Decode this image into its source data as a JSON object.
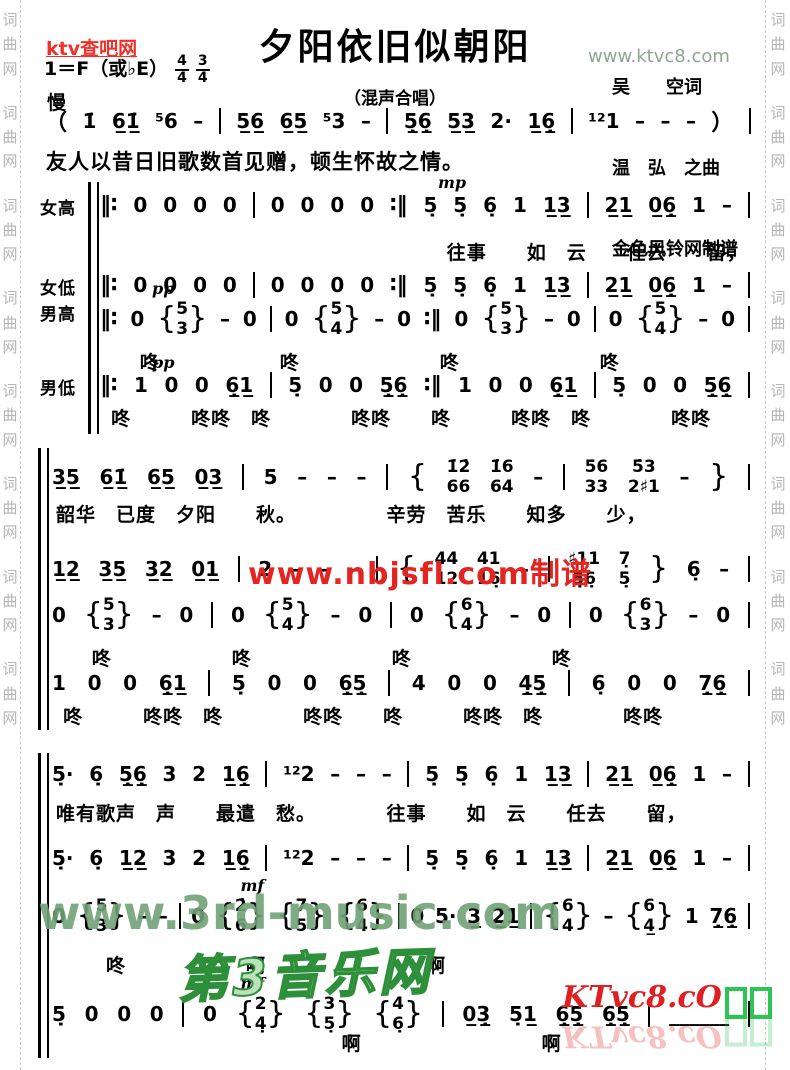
{
  "watermarks": {
    "side_strip_text": "词曲网",
    "ktv_red": "ktv查吧网",
    "ktvc8_top": "www.ktvc8.com",
    "nbjsfl_red": "www.nbjsfl.com制谱",
    "music3rd_green": "www.3rd-music.com",
    "music3rd_cn": "第3音乐网",
    "ktvc8_bottom": "KTvc8.cO",
    "colors": {
      "red": "#e42420",
      "gray_green": "#8fa58f",
      "green": "#70a276",
      "dark_green": "#2e8f3a",
      "strip_gray": "#b5b5b5"
    }
  },
  "header": {
    "title": "夕阳依旧似朝阳",
    "subtitle": "（混声合唱）",
    "key_signature": "1＝F（或♭E）",
    "time_signatures": [
      {
        "num": "4",
        "den": "4"
      },
      {
        "num": "3",
        "den": "4"
      }
    ],
    "tempo": "慢",
    "credits": [
      "吴　　空词",
      "温　弘　之曲",
      "金色风铃网制谱"
    ]
  },
  "intro": {
    "notes": "（ 1̇ 6̲1̲̇ ⁵6 – | 5̲6̲ 6̲5̲ ⁵3 – | 5̲̣6̲̣ 5̲3̲ 2· 1̲6̲̣ | ¹²1 – – – ） |",
    "caption": "友人以昔日旧歌数首见赠，顿生怀故之情。"
  },
  "systems": [
    {
      "top": 182,
      "height": 252,
      "bar_left": 50,
      "content_left": 62,
      "rows": [
        {
          "label": "女高",
          "notes": "‖∶ 0 0 0 0 | 0 0 0 0 ∶‖ 5̣ 5̣ 6̣ 1 1̲3̲ | 2̲1̲ 0̲6̲̣ 1 – |",
          "notes_top": 8,
          "dyn": "mp",
          "dyn_left": 52,
          "lyrics": "往事　　如　云　　任去　　留，",
          "lyrics_top": 56,
          "lyrics_indent": 48
        },
        {
          "label": "女低",
          "notes": "‖∶ 0 0 0 0 | 0 0 0 0 ∶‖ 5̣ 5̣ 6̣ 1 1̲3̲ | 2̲1̲ 0̲6̲̣ 1 – |",
          "notes_top": 88
        },
        {
          "label": "男高",
          "notes": "‖∶ 0 {5/3} – 0 | 0 {5/4} – 0 ∶‖ 0 {5/3} – 0 | 0 {5/4} – 0 |",
          "notes_top": 114,
          "tall": true,
          "dyn": "pp",
          "dyn_left": 8,
          "lyrics": "咚　　　　　　咚　　　　　　　咚　　　　　　　咚",
          "lyrics_top": 166,
          "lyrics_indent": 5
        },
        {
          "label": "男低",
          "notes": "‖∶ 1 0 0 6̲̣1̲ | 5̣ 0 0 5̲̣6̲̣ ∶‖ 1 0 0 6̲̣1̲ | 5̣ 0 0 5̲̣6̲̣ |",
          "notes_top": 188,
          "dyn": "pp",
          "dyn_left": 8,
          "lyrics": "咚　　　咚咚　咚　　　　咚咚　　咚　　　咚咚　咚　　　　咚咚",
          "lyrics_top": 222,
          "lyrics_indent": 1
        }
      ]
    },
    {
      "top": 448,
      "height": 282,
      "bar_left": 0,
      "content_left": 14,
      "rows": [
        {
          "notes": "3̲5̲ 6̲1̲̇ 6̲5̲ 0̲3̲ | 5 – – – | { 1̇2̇/66 1̇6/64 – | 56/33 5̇3/2♯1 – } |",
          "notes_top": 6,
          "tall": true,
          "lyrics": "韶华　已度　夕阳　　秋。　　　　　辛劳　苦乐　　知多　　少，",
          "lyrics_top": 52,
          "lyrics_indent": 0
        },
        {
          "notes": "1̲2̲ 3̲5̲ 3̲2̲ 0̲1̲ | 2 – – – | { 44/12 41/16̣ – | ♯11/5̣6̣ 7̣/5̣ } 6̣ – |",
          "notes_top": 98,
          "tall": true
        },
        {
          "notes": "0 {5/3} – 0 | 0 {5/4} – 0 | 0 {6/4} – 0 | 0 {6/3} – 0 |",
          "notes_top": 144,
          "tall": true,
          "lyrics": "咚　　　　　　咚　　　　　　　咚　　　　　　　咚",
          "lyrics_top": 196,
          "lyrics_indent": 5
        },
        {
          "notes": "1 0 0 6̲̣1̲ | 5̣ 0 0 6̲̣5̲̣ | 4 0 0 4̲̣5̲̣ | 6̣ 0 0 7̲̣6̲̣ |",
          "notes_top": 220,
          "lyrics": "咚　　　咚咚　咚　　　　咚咚　　咚　　　咚咚　咚　　　　咚咚",
          "lyrics_top": 254,
          "lyrics_indent": 1
        }
      ]
    },
    {
      "top": 753,
      "height": 305,
      "bar_left": 0,
      "content_left": 14,
      "rows": [
        {
          "notes": "5̣· 6̣ 5̲̣6̲̣ 3 2 1̲6̲̣ | ¹²2 – – – | 5̣ 5̣ 6̣ 1 1̲3̲ | 2̲1̲ 0̲6̲̣ 1 – |",
          "notes_top": 6,
          "lyrics": "唯有歌声　声　　最遣　愁。　　　　往事　　如　云　　任去　　留，",
          "lyrics_top": 46,
          "lyrics_indent": 0
        },
        {
          "notes": "5̣· 6̣ 1̲2̲ 3 2 1̲6̲̣ | ¹²2 – – – | 5̣ 5̣ 6̣ 1 1̲3̲ | 2̲1̲ 0̲6̲̣ 1 – |",
          "notes_top": 90
        },
        {
          "notes": "0 {5/3} – – | 0 {2̇/6} {7/5} {6/4} | 0 5· 3̲ 2̲1̲ | {6/4} – {6/4̲} 1 7̲̣6̲̣ |",
          "notes_top": 140,
          "tall": true,
          "dyn": "mf",
          "dyn_left": 27,
          "lyrics": "咚　　　　　　啊　　　　　　　　啊",
          "lyrics_top": 198,
          "lyrics_indent": 7
        },
        {
          "notes": "5̣ 0 0 0 | 0 {2/4̣} {3/5̣} {4/6̣} | 0̲3̲̣ 5̣1̲ 6̲̣5̲̣ 6̲̣5̲̣ | ______ |",
          "notes_top": 238,
          "tall": true,
          "dyn": "mf",
          "dyn_left": 27,
          "lyrics": "啊　　　　　　　　　啊",
          "lyrics_top": 276,
          "lyrics_indent": 40
        }
      ]
    }
  ]
}
